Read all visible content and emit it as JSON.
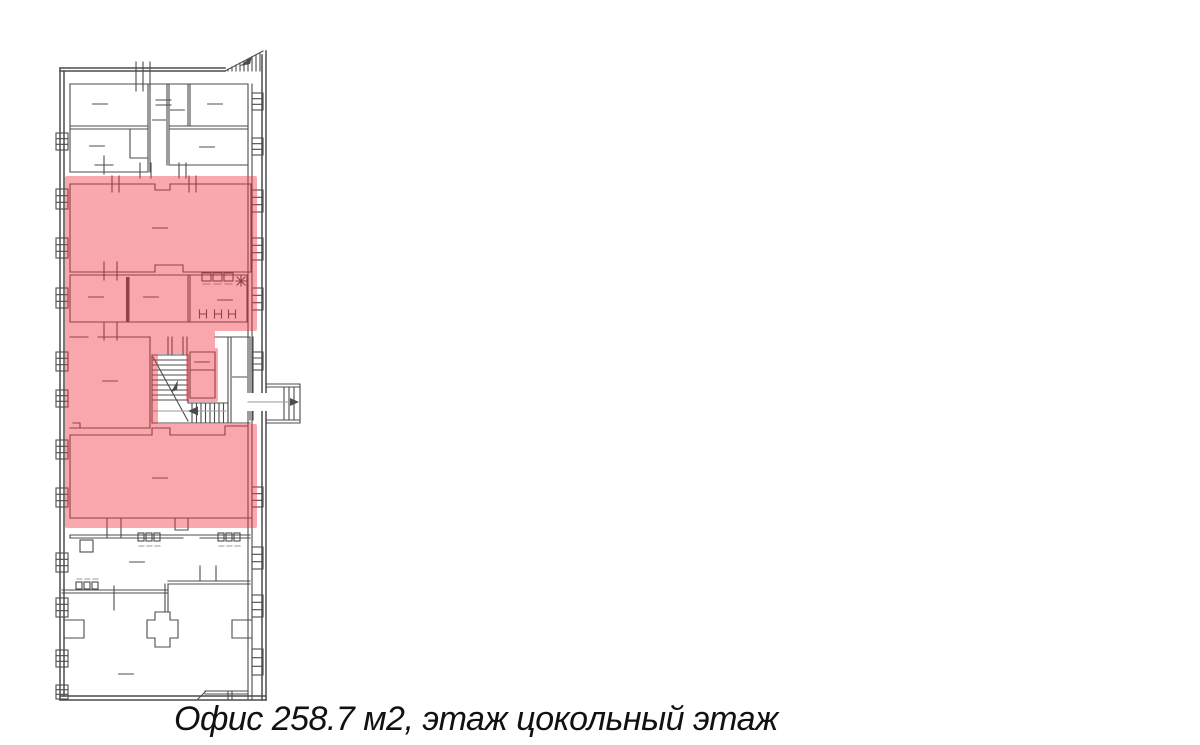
{
  "caption": {
    "text": "Офис 258.7 м2, этаж цокольный этаж"
  },
  "listing": {
    "type": "Офис",
    "area": "258.7 м2",
    "floor": "цокольный этаж"
  },
  "highlight": {
    "meaning": "выделенная площадь офиса",
    "opacity": "0.42"
  },
  "colors": {
    "background": "#ffffff",
    "line": "#4c4c4c",
    "line-light": "#9a9a9a",
    "highlight": "#f1303c",
    "caption-text": "#111111"
  }
}
